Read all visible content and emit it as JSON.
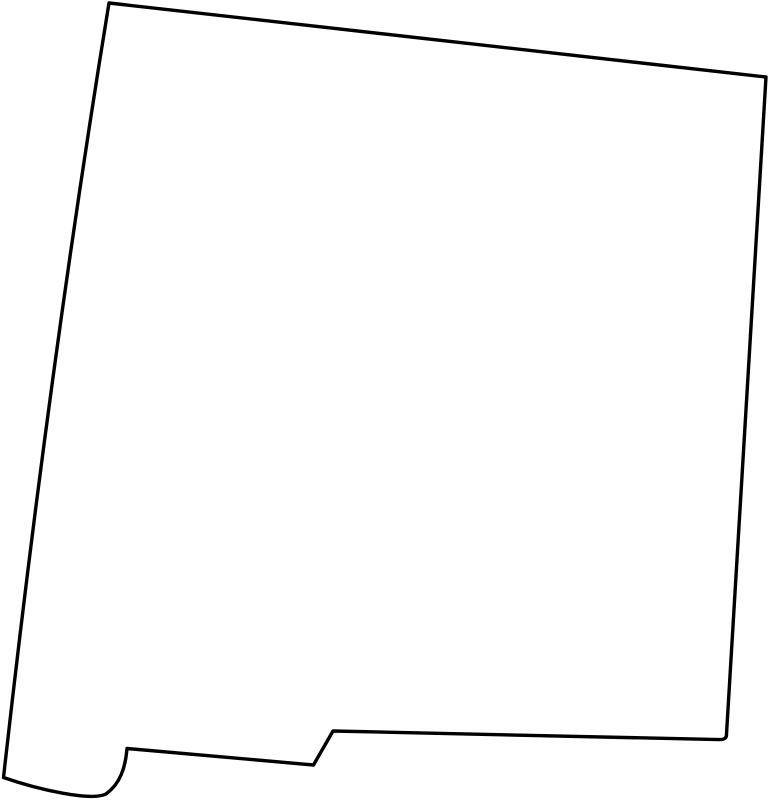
{
  "page": {
    "background_color": "#ffffff"
  },
  "map": {
    "region": "New Mexico",
    "kind": "state-outline",
    "outline_color": "#000000",
    "fill_color": "#ffffff",
    "stroke_width": "3.4",
    "path": "M 109 3 L 766 77 L 726.5 734 Q 727 739.8 719 739.6 L 333 731 L 313.5 765 L 127 748.5 C 125.5 767 120.5 783.5 106 794 C 91 801.5 38 789.5 3.5 777.5 Q 49 370 109 3 Z"
  }
}
